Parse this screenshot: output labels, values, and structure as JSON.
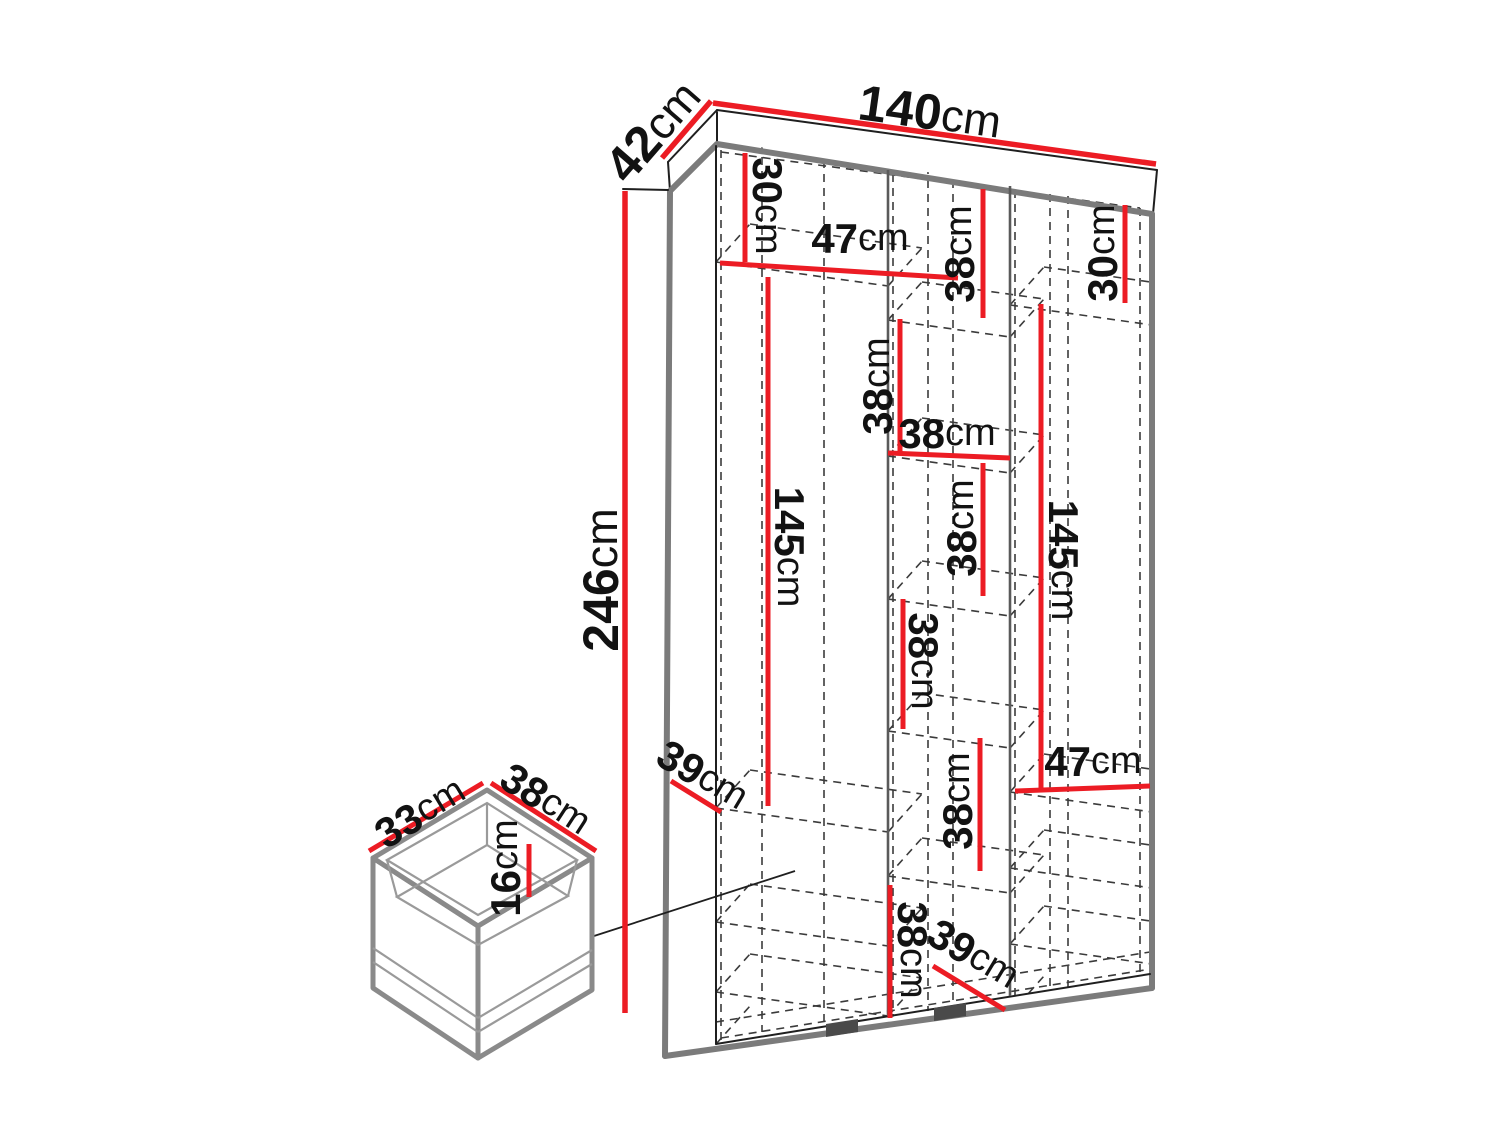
{
  "diagram": {
    "type": "furniture-dimension-drawing",
    "subject": "wardrobe-with-detail-drawer",
    "unit": "cm",
    "colors": {
      "dimension_accent": "#EC1C24",
      "outer_edge": "#7b7b7b",
      "solid_line": "#1f1f1f",
      "hidden_line": "#3b3b3b",
      "background": "#ffffff"
    },
    "wardrobe": {
      "overall": {
        "width": {
          "value": "140",
          "unit": "cm"
        },
        "depth": {
          "value": "42",
          "unit": "cm"
        },
        "height": {
          "value": "246",
          "unit": "cm"
        }
      },
      "interior": {
        "left_top_section_height": {
          "value": "30",
          "unit": "cm"
        },
        "left_top_shelf_width": {
          "value": "47",
          "unit": "cm"
        },
        "middle_top_section_height": {
          "value": "38",
          "unit": "cm"
        },
        "right_top_section_height": {
          "value": "30",
          "unit": "cm"
        },
        "left_hanging_height": {
          "value": "145",
          "unit": "cm"
        },
        "middle_section2_height": {
          "value": "38",
          "unit": "cm"
        },
        "middle_width": {
          "value": "38",
          "unit": "cm"
        },
        "middle_section3_height": {
          "value": "38",
          "unit": "cm"
        },
        "right_hanging_height": {
          "value": "145",
          "unit": "cm"
        },
        "middle_section4_height": {
          "value": "38",
          "unit": "cm"
        },
        "middle_section5_height": {
          "value": "38",
          "unit": "cm"
        },
        "right_shelf_width": {
          "value": "47",
          "unit": "cm"
        },
        "left_shelf_depth": {
          "value": "39",
          "unit": "cm"
        },
        "middle_section6_height": {
          "value": "38",
          "unit": "cm"
        },
        "bottom_shelf_depth": {
          "value": "39",
          "unit": "cm"
        }
      }
    },
    "drawer": {
      "depth": {
        "value": "33",
        "unit": "cm"
      },
      "width": {
        "value": "38",
        "unit": "cm"
      },
      "height": {
        "value": "16",
        "unit": "cm"
      }
    }
  }
}
